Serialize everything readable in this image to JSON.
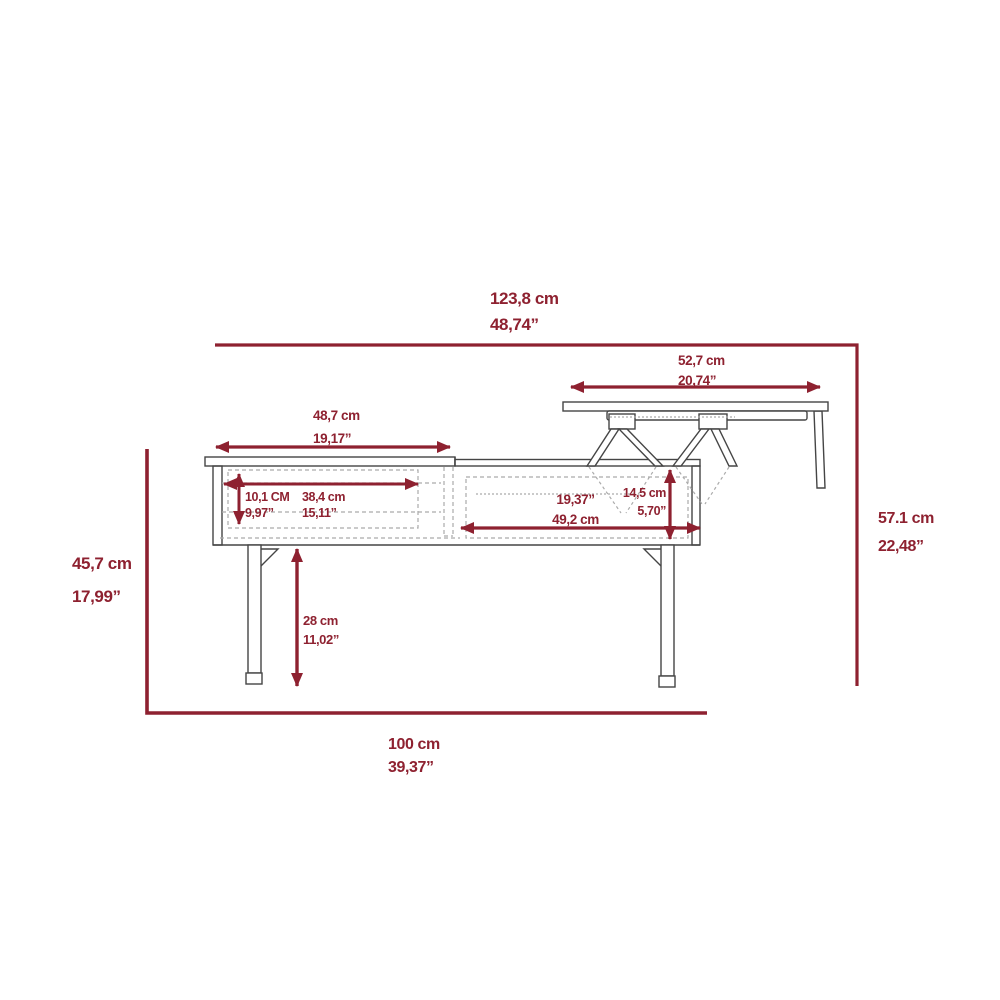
{
  "diagram": {
    "name": "lift-top-coffee-table-dimension-diagram",
    "colors": {
      "dimension_red": "#8E2130",
      "line_gray": "#454545",
      "dashed_gray": "#ABABAB",
      "background": "#FFFFFF"
    },
    "dimensions": {
      "overall_width": {
        "line1": "123,8 cm",
        "line2": "48,74”"
      },
      "lift_top_width": {
        "line1": "52,7 cm",
        "line2": "20,74”"
      },
      "left_top_width": {
        "line1": "48,7 cm",
        "line2": "19,17”"
      },
      "drawer_height": {
        "line1": "10,1 CM",
        "line2": "9,97”"
      },
      "drawer_width": {
        "line1": "38,4 cm",
        "line2": "15,11”"
      },
      "right_compartment_width": {
        "line1": "19,37”",
        "line2": "49,2 cm"
      },
      "right_compartment_depth": {
        "line1": "14,5 cm",
        "line2": "5,70”"
      },
      "table_height": {
        "line1": "45,7 cm",
        "line2": "17,99”"
      },
      "lifted_top_height": {
        "line1": "57.1 cm",
        "line2": "22,48”"
      },
      "leg_height": {
        "line1": "28 cm",
        "line2": "11,02”"
      },
      "base_depth": {
        "line1": "100 cm",
        "line2": "39,37”"
      }
    }
  }
}
